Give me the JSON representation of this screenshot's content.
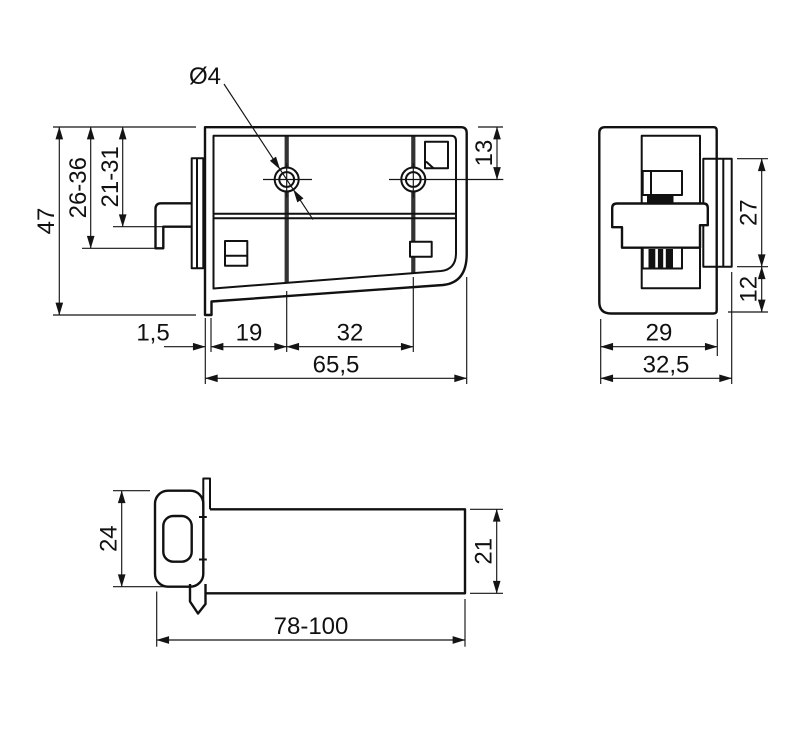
{
  "drawing": {
    "type": "technical-drawing",
    "colors": {
      "line": "#111111",
      "background": "#ffffff",
      "rib": "#333333",
      "thread_fill": "#111111"
    },
    "dims": {
      "front": {
        "hole_dia": "Ø4",
        "overall_height": "47",
        "adjust_range_outer": "26-36",
        "adjust_range_inner": "21-31",
        "hole_to_top": "13",
        "lip_thickness": "1,5",
        "edge_to_hole": "19",
        "hole_spacing": "32",
        "overall_width": "65,5"
      },
      "side": {
        "slot_height": "27",
        "slot_to_bottom": "12",
        "body_depth": "29",
        "overall_depth": "32,5"
      },
      "bottom": {
        "head_width": "24",
        "body_width": "21",
        "length_range": "78-100"
      }
    }
  }
}
